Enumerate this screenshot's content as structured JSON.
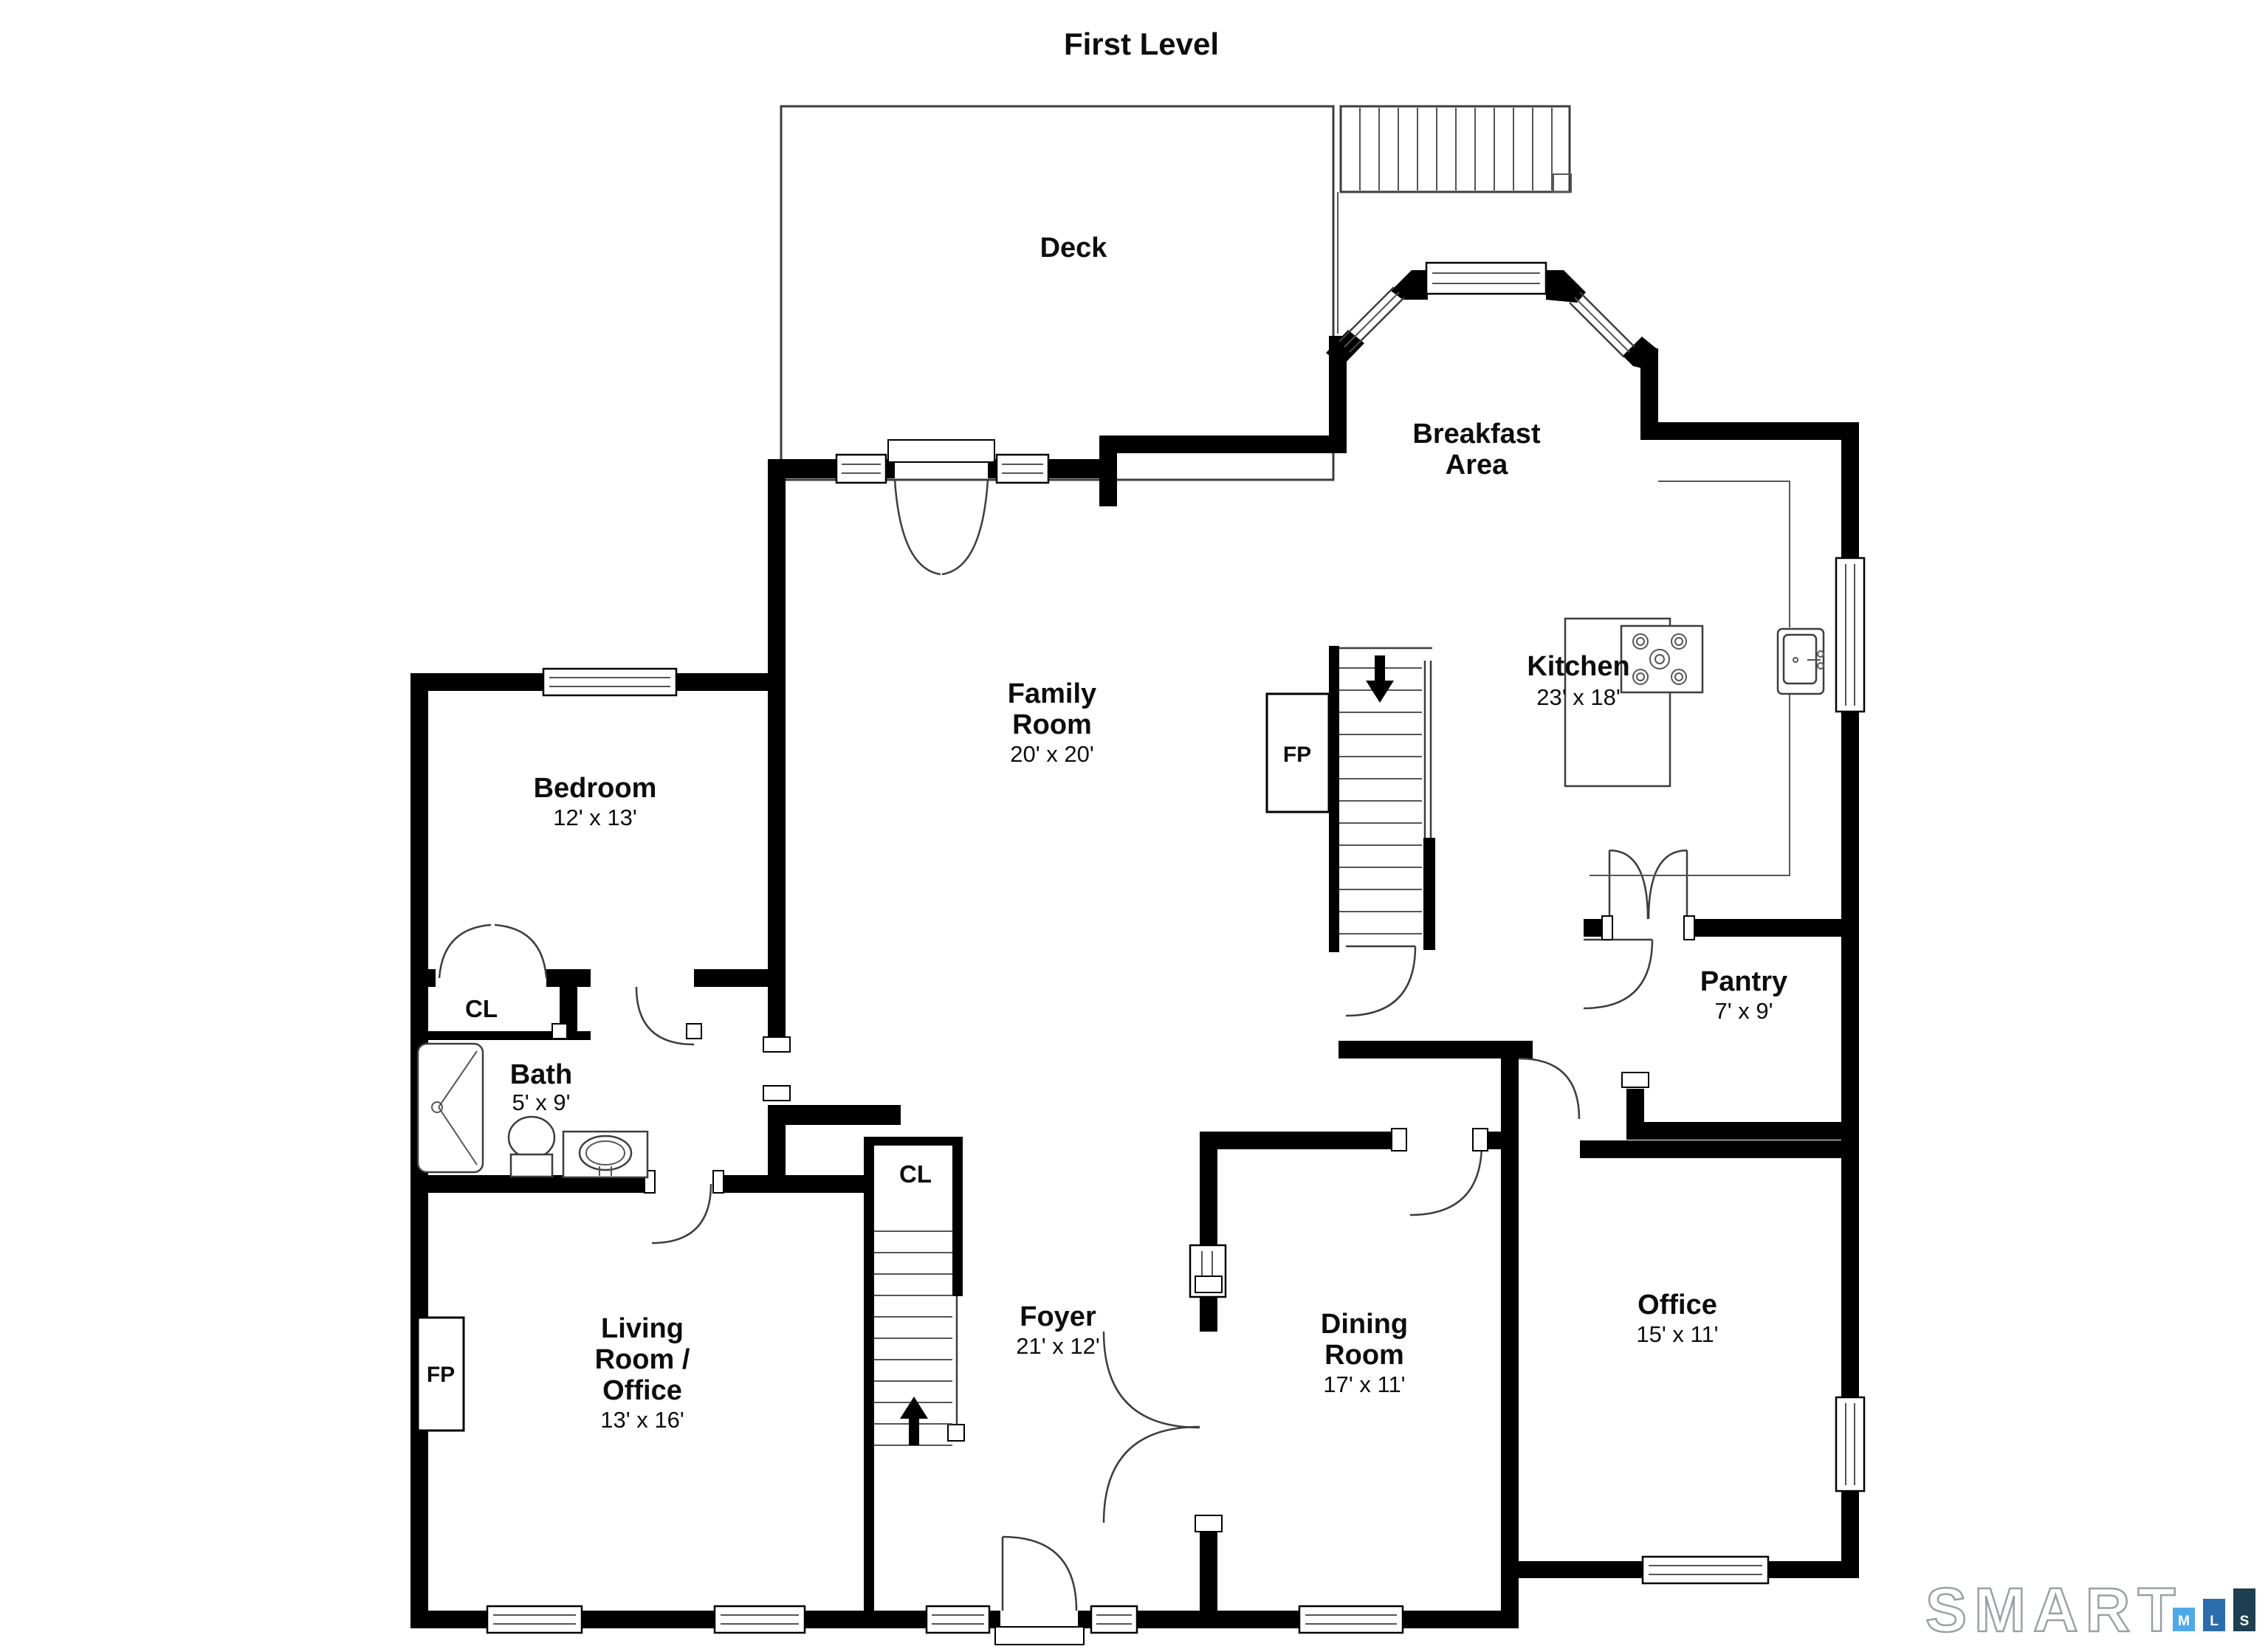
{
  "title": "First Level",
  "rooms": {
    "deck": {
      "name": "Deck"
    },
    "breakfast": {
      "line1": "Breakfast",
      "line2": "Area"
    },
    "family": {
      "line1": "Family",
      "line2": "Room",
      "dims": "20' x 20'"
    },
    "kitchen": {
      "name": "Kitchen",
      "dims": "23' x 18'"
    },
    "bedroom": {
      "name": "Bedroom",
      "dims": "12' x 13'"
    },
    "bath": {
      "name": "Bath",
      "dims": "5' x 9'"
    },
    "pantry": {
      "name": "Pantry",
      "dims": "7' x 9'"
    },
    "living": {
      "line1": "Living",
      "line2": "Room /",
      "line3": "Office",
      "dims": "13' x 16'"
    },
    "foyer": {
      "name": "Foyer",
      "dims": "21' x 12'"
    },
    "dining": {
      "line1": "Dining",
      "line2": "Room",
      "dims": "17' x 11'"
    },
    "office": {
      "name": "Office",
      "dims": "15' x 11'"
    }
  },
  "closets": {
    "bedroom_closet": "CL",
    "foyer_closet": "CL"
  },
  "fireplaces": {
    "family": "FP",
    "living": "FP"
  },
  "logo": {
    "brand": "SMART",
    "bars": [
      {
        "letter": "M",
        "color": "#4FA8E8"
      },
      {
        "letter": "L",
        "color": "#2B6CAD"
      },
      {
        "letter": "S",
        "color": "#1E3E51"
      }
    ]
  },
  "colors": {
    "wall": "#000000",
    "line": "#3d3d3d"
  }
}
